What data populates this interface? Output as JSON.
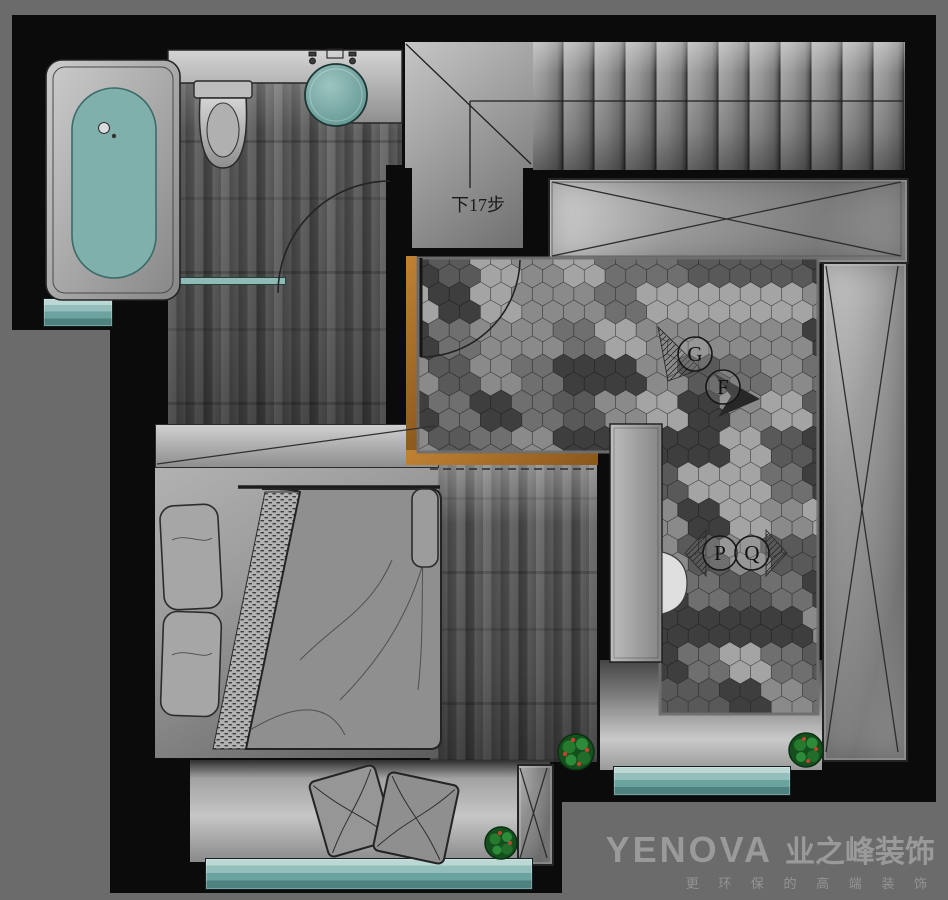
{
  "colors": {
    "background": "#6b6b6b",
    "wall": "#0b0b0b",
    "teal_water": "#7fb0ac",
    "teal_window": "#79aaa6",
    "orange_threshold": "#b5782e",
    "floor_light": "#a8a8a8",
    "logo_text": "#9a9a9a"
  },
  "annotations": {
    "stairs_label": "下17步",
    "marker_g": "G",
    "marker_f": "F",
    "marker_p": "P",
    "marker_q": "Q"
  },
  "logo": {
    "brand_latin": "YENOVA",
    "brand_cn": "业之峰装饰",
    "tagline": "更 环 保 的 高 端 装 饰"
  },
  "hex": {
    "radius": 12,
    "palette": [
      "#3e3e3e",
      "#595959",
      "#6f6f6f",
      "#8a8a8a",
      "#a4a4a4"
    ],
    "weights": [
      0.2,
      0.4,
      0.58,
      0.8,
      1.01
    ],
    "region": {
      "x1": 418,
      "y1": 258,
      "x2": 818,
      "y2": 714,
      "notch_x": 660,
      "notch_y": 452
    }
  }
}
